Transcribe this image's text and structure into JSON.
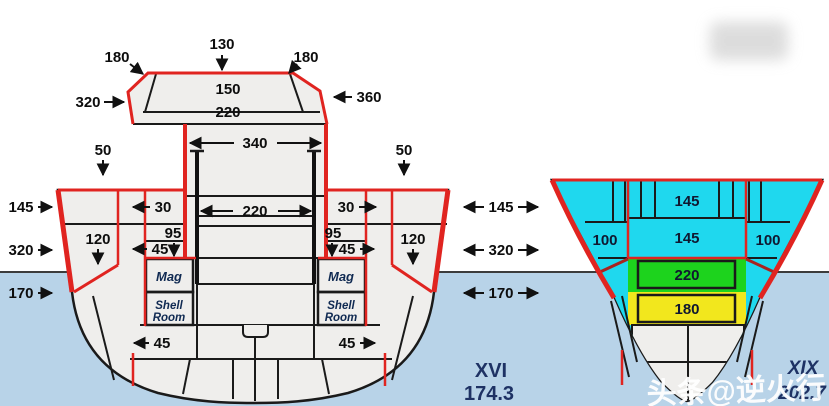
{
  "left_ship": {
    "name": "XVI",
    "value": "174.3",
    "tower": {
      "top": "130",
      "corner_left": "180",
      "corner_right": "180",
      "roof": "150",
      "deck": "220",
      "side_left": "320",
      "side_right": "360"
    },
    "deck": {
      "edge_left": "50",
      "edge_right": "50",
      "barbette": "340",
      "armor_deck": "220",
      "splinter_left": "30",
      "splinter_right": "30",
      "mid_left": "95",
      "mid_right": "95",
      "bulkhead_left": "45",
      "bulkhead_right": "45",
      "upper_belt_left": "120",
      "upper_belt_right": "120",
      "bottom_left": "45",
      "bottom_right": "45"
    },
    "rooms": {
      "mag_left": "Mag",
      "mag_right": "Mag",
      "shell_left_1": "Shell",
      "shell_left_2": "Room",
      "shell_right_1": "Shell",
      "shell_right_2": "Room"
    },
    "belt": {
      "top": "145",
      "main": "320",
      "lower": "170"
    }
  },
  "center_belt": {
    "top": "145",
    "main": "320",
    "lower": "170"
  },
  "right_ship": {
    "name": "XIX",
    "value": "202.7",
    "deck_upper": "145",
    "deck_main": "145",
    "side_left": "100",
    "side_right": "100",
    "citadel": "220",
    "lower": "180"
  },
  "watermark": "头条@逆火行",
  "colors": {
    "armor_highlight_red": "#e02420",
    "torpedo_protection_cyan": "#1fd8ee",
    "deck_armor_purple": "#8f8fd8",
    "magazine_green": "#1dd31d",
    "citadel_yellow": "#f2e71d",
    "water_blue": "#b8d3e8",
    "label_navy": "#1e3264"
  }
}
